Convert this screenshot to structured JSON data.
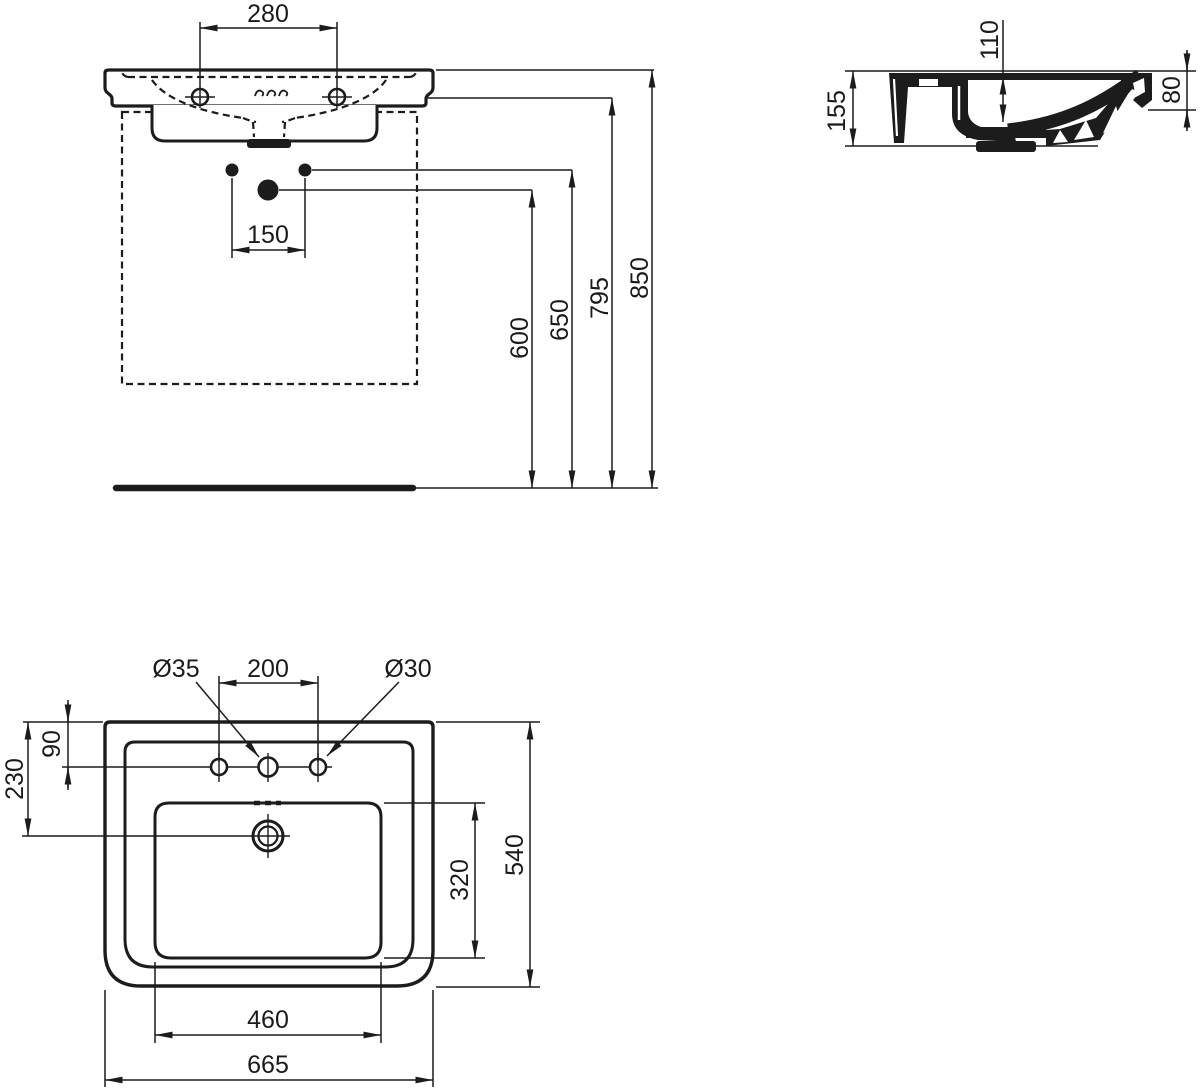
{
  "drawing": {
    "front_view": {
      "tap_holes_spacing": "280",
      "fixing_bolts_spacing": "150",
      "drain_outlet_height": "600",
      "fixing_bolts_height": "650",
      "basin_underside_height": "795",
      "rim_height": "850"
    },
    "side_view": {
      "body_height": "155",
      "bowl_depth": "110",
      "front_apron_height": "80"
    },
    "plan_view": {
      "center_hole_diameter": "Ø35",
      "outer_tap_holes_spacing": "200",
      "side_hole_diameter": "Ø30",
      "rear_edge_to_tap_holes": "90",
      "rear_edge_to_overflow": "230",
      "overall_depth": "540",
      "bowl_inner_depth": "320",
      "bowl_inner_width": "460",
      "overall_width": "665"
    }
  }
}
